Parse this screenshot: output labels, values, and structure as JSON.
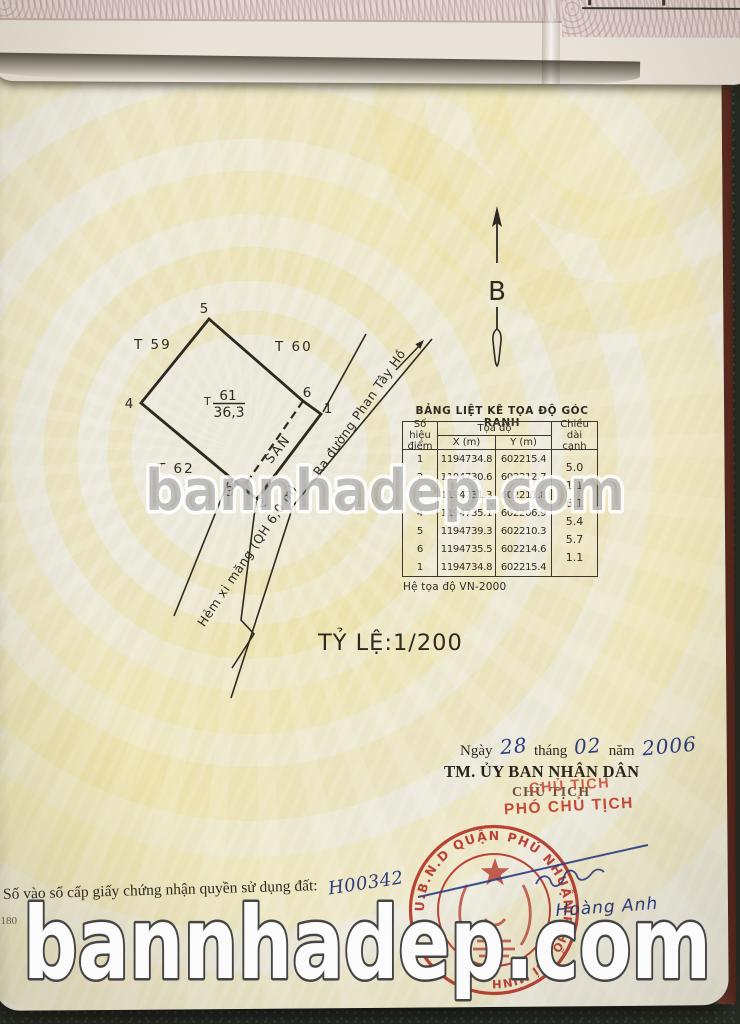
{
  "watermarks": {
    "middle": "bannhadep.com",
    "bottom": "bannhadep.com"
  },
  "map": {
    "north_label": "B",
    "scale_label": "TỶ LỆ:1/200",
    "plot": {
      "prefix": "T",
      "number": "61",
      "area": "36,3"
    },
    "neighbors": {
      "left": "T 59",
      "right": "T 60",
      "bottom_left": "T 62"
    },
    "vertices": {
      "v1": "1",
      "v2": "2",
      "v3": "3",
      "v4": "4",
      "v5": "5",
      "v6": "6"
    },
    "yard_label": "SÂN",
    "road_label": "Ra đường Phan Tây Hồ",
    "alley_label": "Hẻm xi măng (QH 6,0 m)"
  },
  "coordinate_table": {
    "title": "BẢNG LIỆT KÊ TỌA ĐỘ GÓC RANH",
    "headers": {
      "point": "Số hiệu điểm",
      "coords": "Tọa độ",
      "x": "X (m)",
      "y": "Y (m)",
      "edge": "Chiều dài cạnh"
    },
    "rows": [
      {
        "point": "1",
        "x": "1194734.8",
        "y": "602215.4"
      },
      {
        "point": "2",
        "x": "1194730.6",
        "y": "602212.7"
      },
      {
        "point": "3",
        "x": "1194731.3",
        "y": "602211.8"
      },
      {
        "point": "4",
        "x": "1194735.1",
        "y": "602206.9"
      },
      {
        "point": "5",
        "x": "1194739.3",
        "y": "602210.3"
      },
      {
        "point": "6",
        "x": "1194735.5",
        "y": "602214.6"
      },
      {
        "point": "1",
        "x": "1194734.8",
        "y": "602215.4"
      }
    ],
    "edge_lengths": [
      "5.0",
      "1.1",
      "6.1",
      "5.4",
      "5.7",
      "1.1"
    ],
    "footer": "Hệ tọa độ VN-2000"
  },
  "approval": {
    "date_word": "Ngày",
    "day": "28",
    "month_word": "tháng",
    "month": "02",
    "year_word": "năm",
    "year": "2006",
    "org": "TM. ỦY BAN NHÂN DÂN",
    "chairman_printed": "CHỦ TỊCH",
    "chairman_stamp_overlay": "CHỦ TỊCH",
    "deputy_red": "PHÓ CHỦ TỊCH",
    "signer_name": "Hoàng Anh"
  },
  "stamp": {
    "arc_top": "U.B.N.D QUẬN PHÚ NHUẬN",
    "arc_right": "TP. HỒ CHÍ MINH"
  },
  "registry": {
    "label": "Số vào sổ cấp giấy chứng nhận quyền sử dụng đất:",
    "number": "H00342",
    "corner_code": "0180"
  },
  "colors": {
    "stamp_red": "#b5372a",
    "ink_blue": "#2b3b7e",
    "line_dark": "#2e2a21",
    "page_cream": "#ebe8da",
    "pattern_yellow": "#eeddA0"
  }
}
